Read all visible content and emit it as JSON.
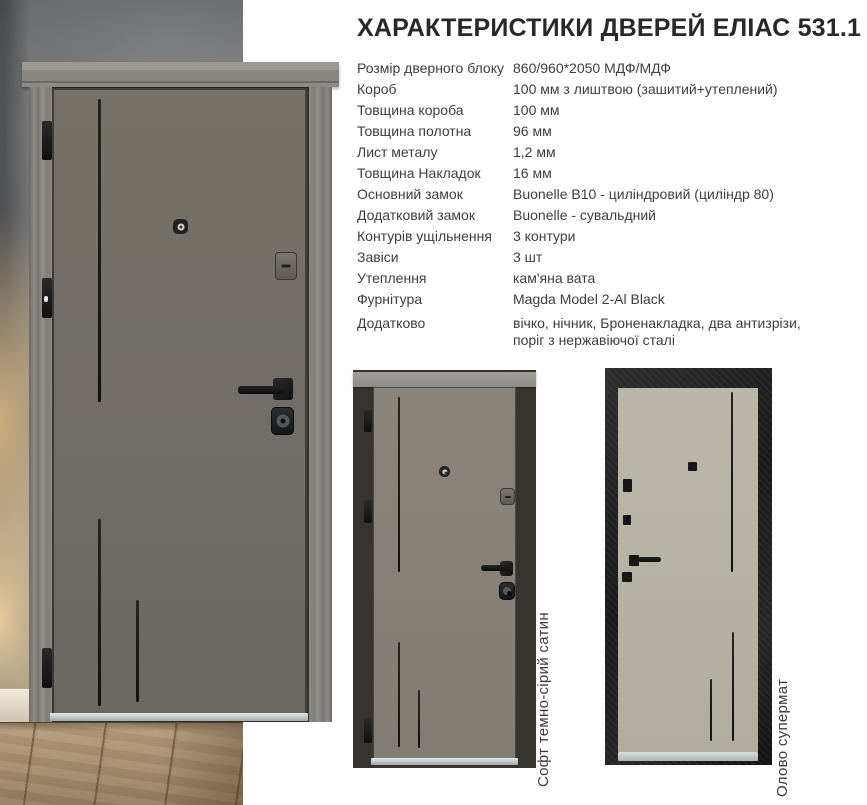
{
  "title": "ХАРАКТЕРИСТИКИ ДВЕРЕЙ ЕЛІАС 531.1",
  "specs": [
    {
      "label": "Розмір дверного блоку",
      "value": "860/960*2050 МДФ/МДФ"
    },
    {
      "label": "Короб",
      "value": "100 мм з лиштвою (зашитий+утеплений)"
    },
    {
      "label": "Товщина короба",
      "value": "100 мм"
    },
    {
      "label": "Товщина полотна",
      "value": "96 мм"
    },
    {
      "label": "Лист металу",
      "value": "1,2 мм"
    },
    {
      "label": "Товщина Накладок",
      "value": "16 мм"
    },
    {
      "label": "Основний замок",
      "value": "Buonelle B10 - циліндровий (циліндр 80)"
    },
    {
      "label": "Додатковий замок",
      "value": "Buonelle - сувальдний"
    },
    {
      "label": "Контурів ущільнення",
      "value": "3 контури"
    },
    {
      "label": "Завіси",
      "value": "3 шт"
    },
    {
      "label": "Утеплення",
      "value": "кам'яна вата"
    },
    {
      "label": "Фурнітура",
      "value": "Magda Model 2-Al Black"
    },
    {
      "label": "Додатково",
      "value": "вічко, нічник, Броненакладка, два антизрізи, поріг з нержавіючої сталі"
    }
  ],
  "variants": [
    {
      "name": "soft-dark-grey-satin",
      "label": "Софт темно-сірий сатин"
    },
    {
      "name": "tin-supermat",
      "label": "Олово супермат"
    }
  ],
  "palette": {
    "outer_leaf": "#716d67",
    "outer_frame": "#8b8783",
    "inner_leaf": "#b5b1a3",
    "inner_frame": "#1c1c1c",
    "hardware_black": "#151515",
    "concrete_wall": "#797b7d",
    "wood_floor": "#a98e6d",
    "threshold_steel": "#c9cdcf",
    "text": "#3e3e3e"
  }
}
